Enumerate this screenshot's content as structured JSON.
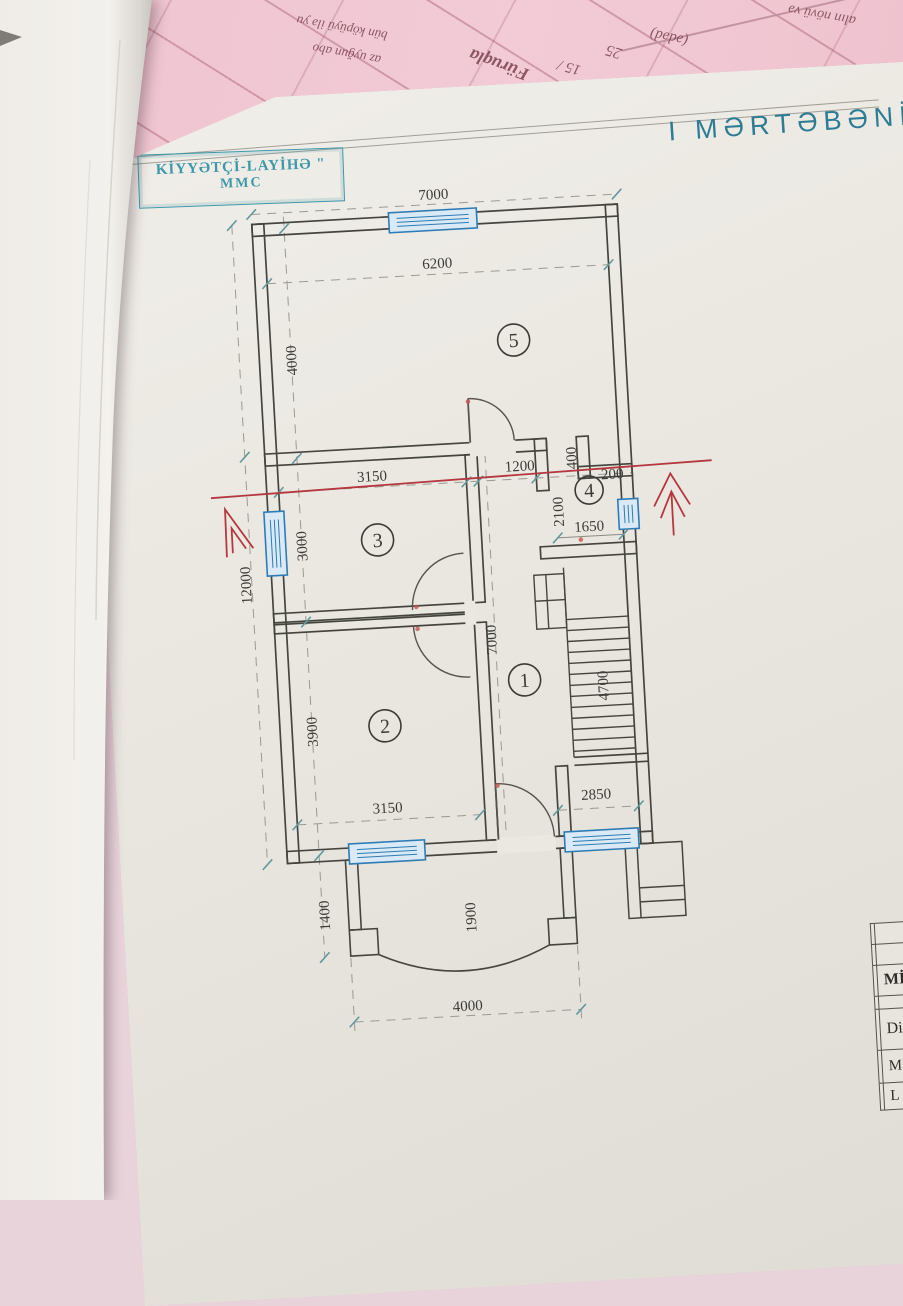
{
  "background": {
    "pink_fragments": {
      "f1": "bün köpüyü ilə yu",
      "f2": "az uyğun abo",
      "f3": "Füruqla",
      "f4": "15 /",
      "f5": "25",
      "f6": "(ədəd)",
      "f7": "alın növü və"
    }
  },
  "sheet": {
    "title": "I MƏRTƏBƏNİN",
    "stamp": {
      "line1": "KİYYƏTÇİ-LAYİHƏ \"",
      "line2": "MMC"
    },
    "title_block_rows": {
      "r3": "MİQ",
      "r5": "Di",
      "r6": "M",
      "r7": "L"
    }
  },
  "plan": {
    "rooms": {
      "r1": "1",
      "r2": "2",
      "r3": "3",
      "r4": "4",
      "r5": "5"
    },
    "dims": {
      "top_width": "7000",
      "room5_width": "6200",
      "room5_height": "4000",
      "total_height": "12000",
      "room3_width": "3150",
      "corridor_width": "1200",
      "niche_depth": "400",
      "niche_offset": "200",
      "room4_opening": "2100",
      "room4_width": "1650",
      "room3_height": "3000",
      "room2_height": "3900",
      "hall_length": "7000",
      "stair_length": "4700",
      "room2_width": "3150",
      "stair_width": "2850",
      "porch_offset": "1400",
      "porch_depth": "1900",
      "porch_width": "4000"
    }
  }
}
